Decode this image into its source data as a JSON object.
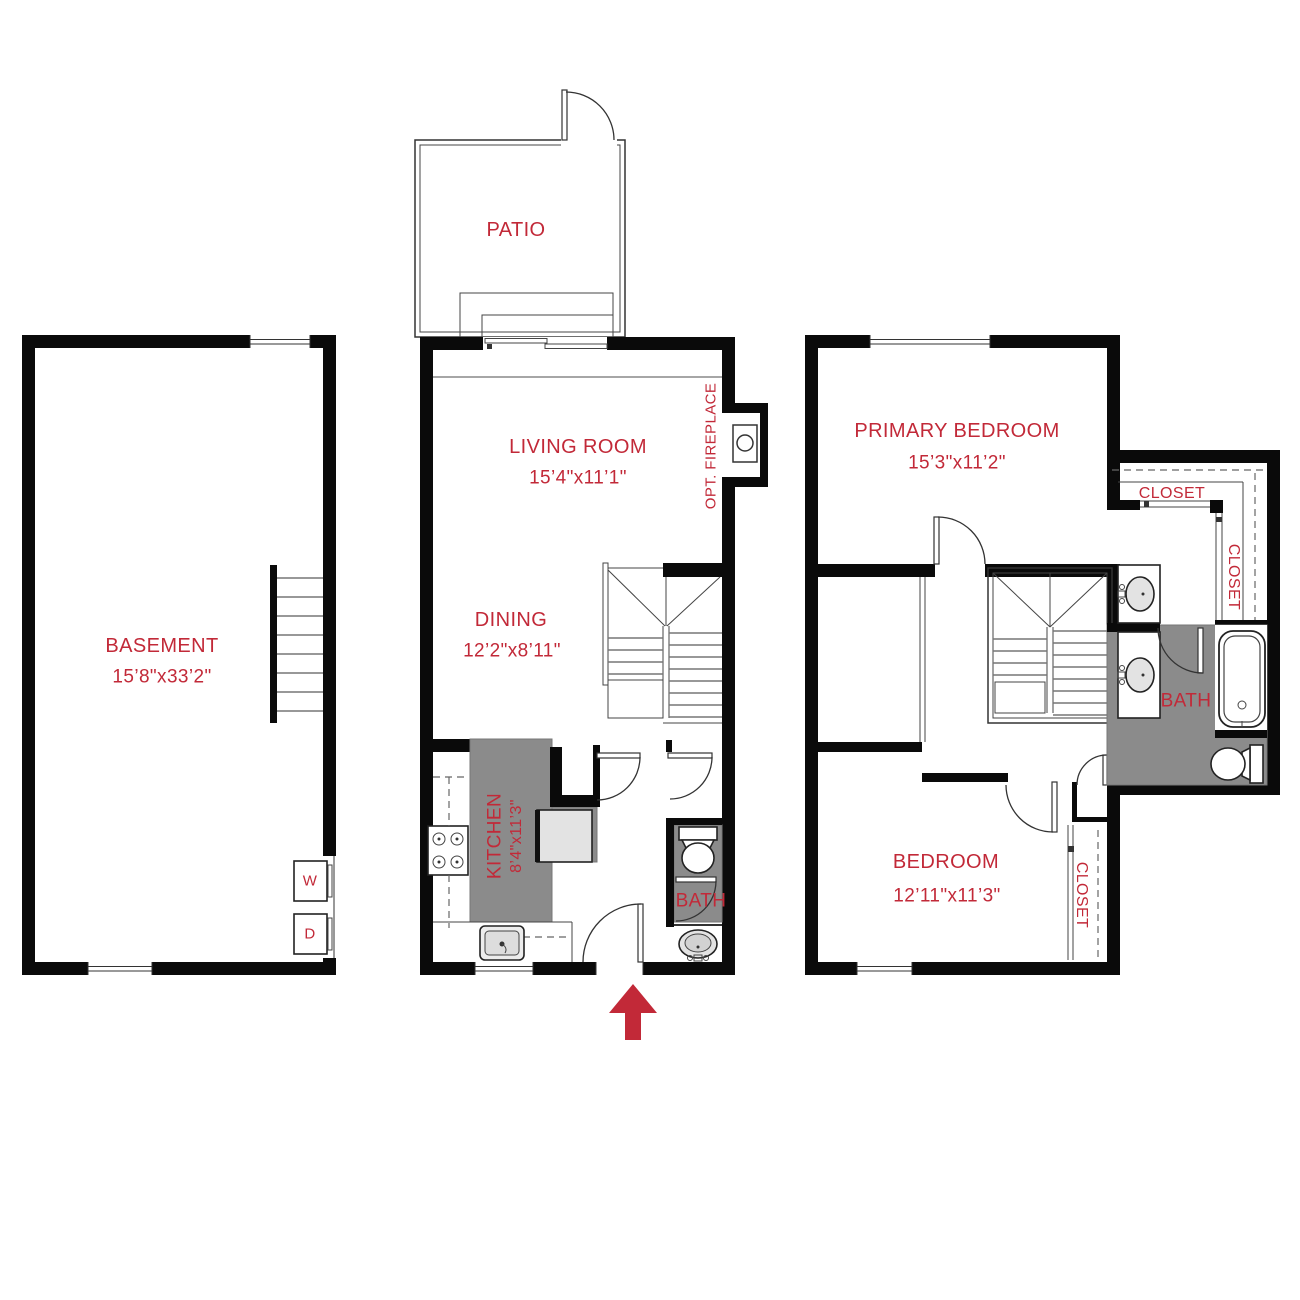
{
  "colors": {
    "label": "#C22938",
    "wall": "#0A0A0A",
    "floor": "#8B8B8B",
    "fixture": "#E3E3E3"
  },
  "labels": {
    "basement": {
      "name": "BASEMENT",
      "dims": "15’8\"x33’2\""
    },
    "patio": {
      "name": "PATIO"
    },
    "living": {
      "name": "LIVING ROOM",
      "dims": "15’4\"x11’1\""
    },
    "dining": {
      "name": "DINING",
      "dims": "12’2\"x8’11\""
    },
    "kitchen": {
      "name": "KITCHEN",
      "dims": "8’4\"x11’3\""
    },
    "fireplace": {
      "name": "OPT. FIREPLACE"
    },
    "bath_main": {
      "name": "BATH"
    },
    "primary": {
      "name": "PRIMARY BEDROOM",
      "dims": "15’3\"x11’2\""
    },
    "closet_primary_top": {
      "name": "CLOSET"
    },
    "closet_primary_side": {
      "name": "CLOSET"
    },
    "bath_upper": {
      "name": "BATH"
    },
    "bedroom": {
      "name": "BEDROOM",
      "dims": "12’11\"x11’3\""
    },
    "closet_bedroom": {
      "name": "CLOSET"
    },
    "washer": {
      "label": "W"
    },
    "dryer": {
      "label": "D"
    }
  },
  "icons": {
    "entry_arrow": "up-arrow",
    "fixtures": [
      "stairs",
      "toilet",
      "bathtub",
      "sink",
      "vanity-sink",
      "stove",
      "fridge",
      "washer",
      "dryer",
      "door-swing",
      "window",
      "sliding-door",
      "fireplace"
    ]
  }
}
